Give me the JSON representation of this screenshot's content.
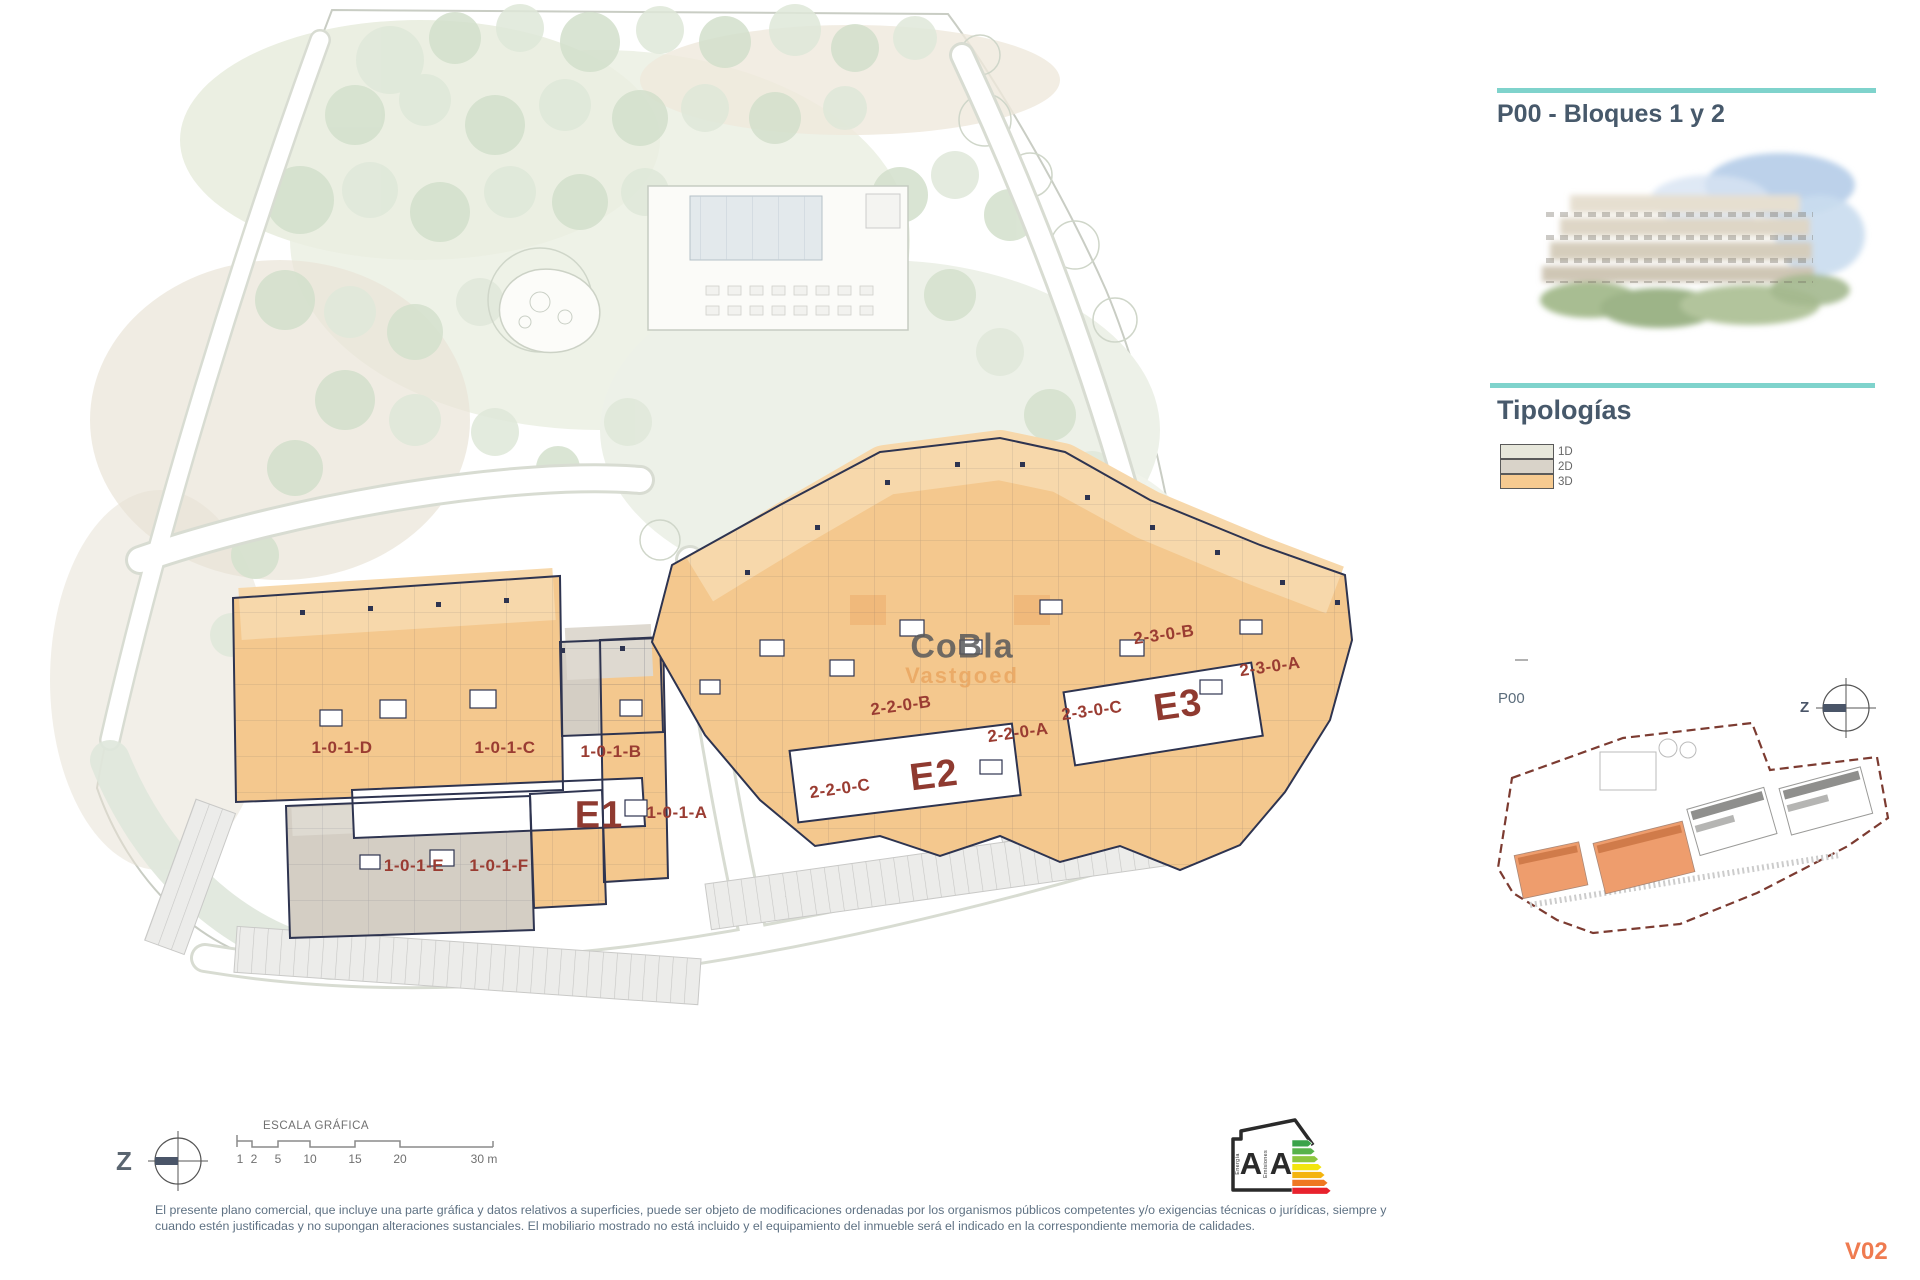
{
  "panel": {
    "title": "P00 - Bloques 1 y 2",
    "tipologias_title": "Tipologías",
    "legend": [
      {
        "label": "1D",
        "color": "#e7e7db"
      },
      {
        "label": "2D",
        "color": "#d9d3c9"
      },
      {
        "label": "3D",
        "color": "#f6ca90"
      }
    ],
    "keyplan_label": "P00",
    "north_label": "Z"
  },
  "plan": {
    "watermark_line1": "CoBla",
    "watermark_line2": "Vastgoed",
    "north_label": "Z",
    "units": [
      {
        "text": "1-0-1-D"
      },
      {
        "text": "1-0-1-C"
      },
      {
        "text": "1-0-1-B"
      },
      {
        "text": "1-0-1-A"
      },
      {
        "text": "1-0-1-E"
      },
      {
        "text": "1-0-1-F"
      },
      {
        "text": "2-2-0-B"
      },
      {
        "text": "2-2-0-A"
      },
      {
        "text": "2-2-0-C"
      },
      {
        "text": "2-3-0-B"
      },
      {
        "text": "2-3-0-C"
      },
      {
        "text": "2-3-0-A"
      }
    ],
    "entrances": [
      {
        "text": "E1"
      },
      {
        "text": "E2"
      },
      {
        "text": "E3"
      }
    ]
  },
  "scalebar": {
    "title": "ESCALA GRÁFICA",
    "ticks": [
      "1",
      "2",
      "5",
      "10",
      "15",
      "20",
      "30 m"
    ]
  },
  "energy": {
    "energy_letter": "A",
    "emissions_letter": "A",
    "energy_label": "Energía",
    "emissions_label": "Emisiones"
  },
  "footer": {
    "disclaimer_line1": "El presente plano comercial, que incluye una parte gráfica y datos relativos a superficies, puede ser objeto de modificaciones ordenadas por los organismos públicos competentes y/o exigencias técnicas o jurídicas, siempre y",
    "disclaimer_line2": "cuando estén justificadas y no supongan alteraciones sustanciales. El mobiliario mostrado no está incluido y el equipamiento del inmueble será el indicado en la correspondiente memoria de calidades.",
    "version": "V02"
  },
  "colors": {
    "accent_teal": "#7fd3cc",
    "title_text": "#47596b",
    "unit_label": "#9a3c32",
    "building_orange": "#f4c88e",
    "building_gray": "#d4cec4",
    "walls": "#2e3450",
    "minimap_boundary": "#7c3b31",
    "minimap_highlight": "#ee9d6d",
    "version_orange": "#ef7b50"
  }
}
